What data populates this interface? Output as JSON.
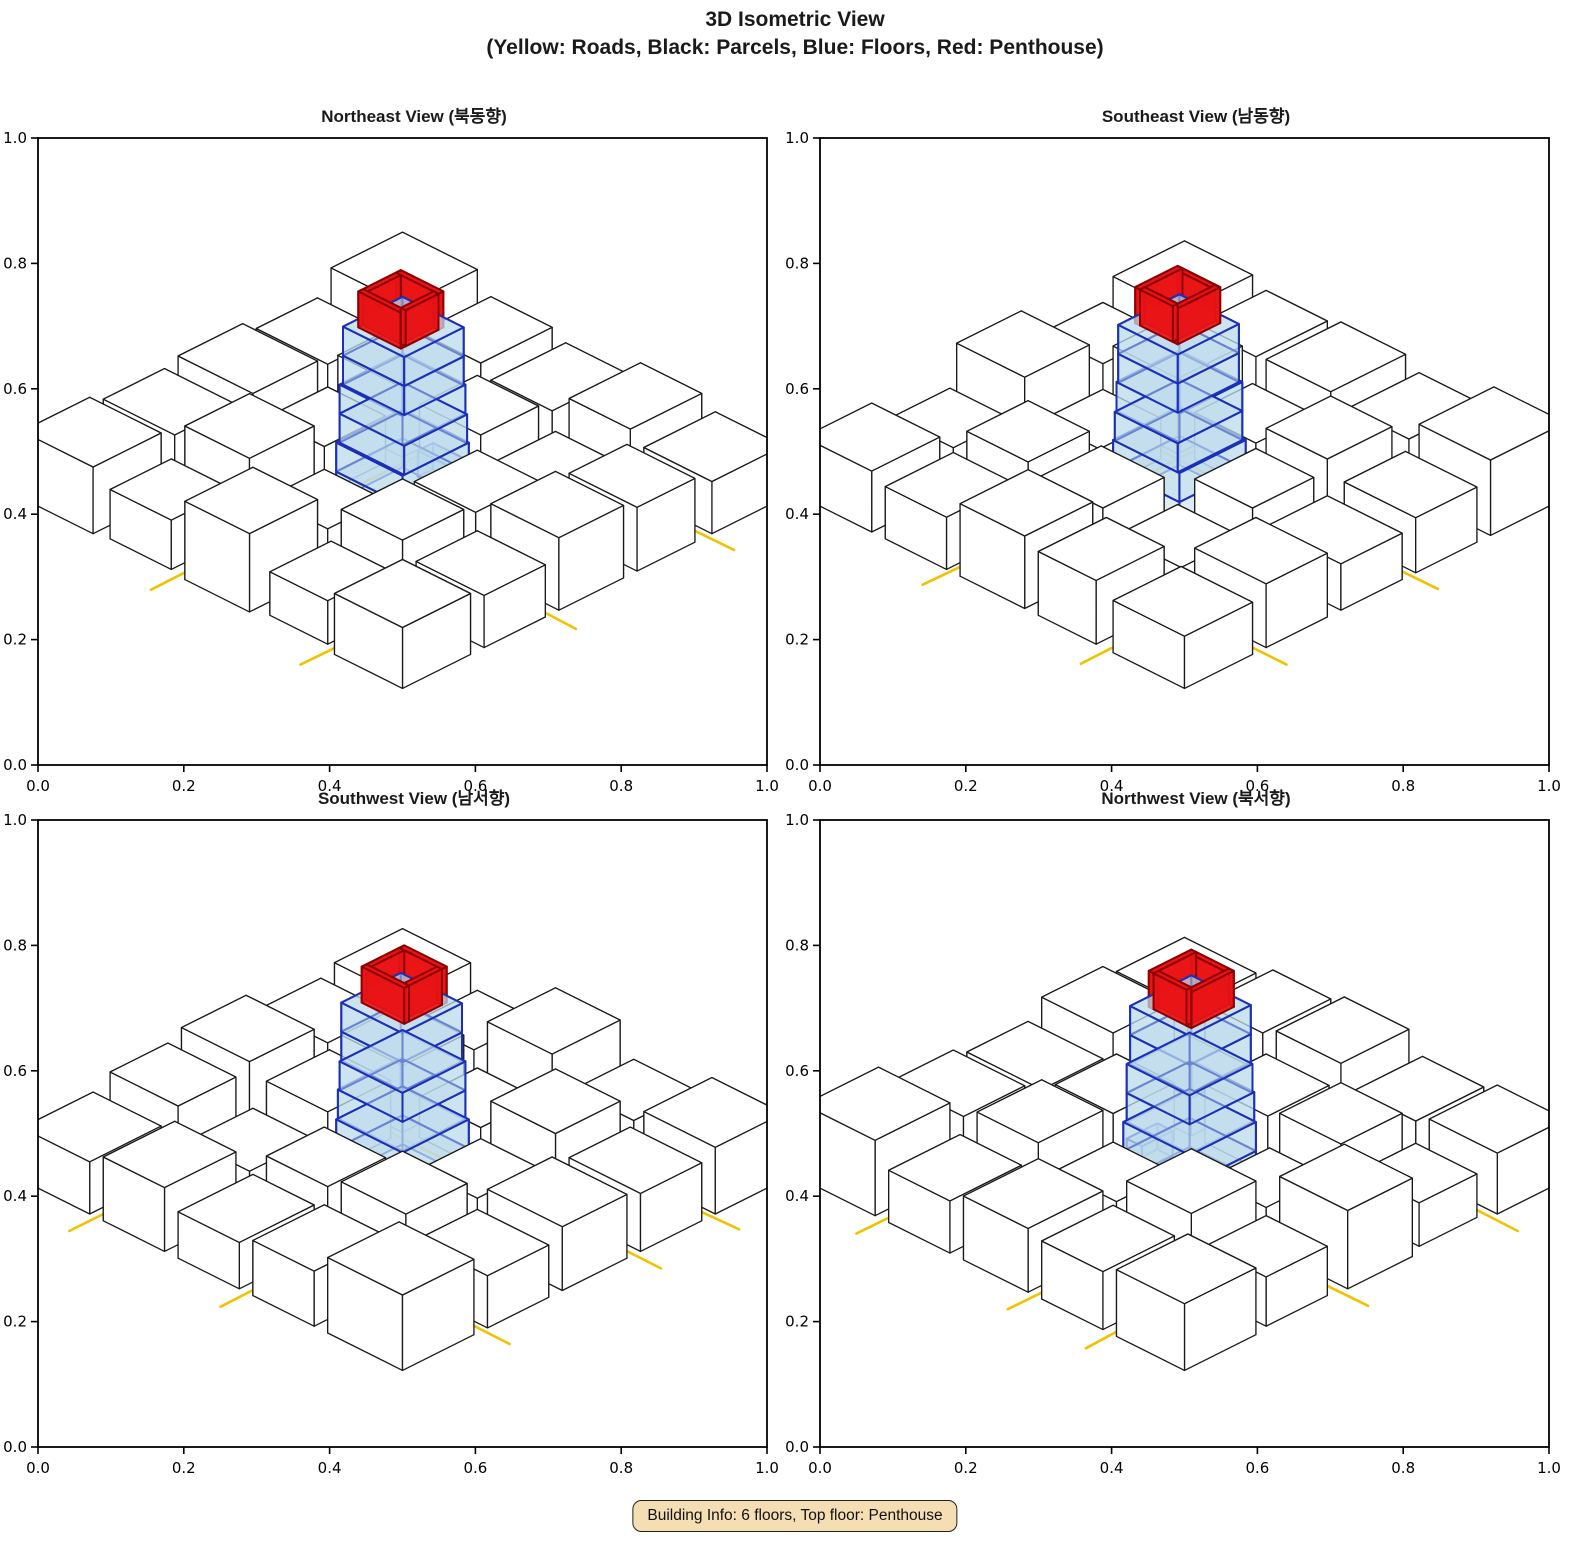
{
  "header": {
    "title_line1": "3D Isometric View",
    "title_line2": "(Yellow: Roads, Black: Parcels, Blue: Floors, Red: Penthouse)"
  },
  "footer": {
    "building_info": "Building Info: 6 floors, Top floor: Penthouse"
  },
  "chart_data": {
    "type": "3d-isometric-multiview",
    "title": "3D Isometric View",
    "subtitle": "(Yellow: Roads, Black: Parcels, Blue: Floors, Red: Penthouse)",
    "views": [
      {
        "title": "Northeast View (북동향)",
        "rotation_deg": 0
      },
      {
        "title": "Southeast View (남동향)",
        "rotation_deg": 90
      },
      {
        "title": "Southwest View (남서향)",
        "rotation_deg": 180
      },
      {
        "title": "Northwest View (북서향)",
        "rotation_deg": 270
      }
    ],
    "axes": {
      "xlim": [
        0.0,
        1.0
      ],
      "ylim": [
        0.0,
        1.0
      ],
      "tick_labels": [
        "0.0",
        "0.2",
        "0.4",
        "0.6",
        "0.8",
        "1.0"
      ]
    },
    "legend": {
      "roads": "Yellow",
      "parcels": "Black",
      "floors": "Blue",
      "penthouse": "Red"
    },
    "building_info": {
      "floors": 6,
      "top_floor": "Penthouse"
    },
    "colors": {
      "road": "#f2c200",
      "parcel_fill": "#ffffff",
      "parcel_edge": "#1a1a1a",
      "floor_fill": "#bcd9ec",
      "floor_edge": "#1b2fb8",
      "penthouse_fill": "#e81416",
      "penthouse_edge": "#8e0000",
      "info_bg": "#f5deb3",
      "axis": "#000000"
    },
    "scene": {
      "parcels": [
        [
          -5.6,
          3.6,
          -3.5,
          5.6,
          1.15
        ],
        [
          -3.1,
          3.7,
          -1.3,
          5.5,
          0.85
        ],
        [
          -0.8,
          3.6,
          1.1,
          5.6,
          1.35
        ],
        [
          1.5,
          3.6,
          3.2,
          5.4,
          0.75
        ],
        [
          3.6,
          3.6,
          5.6,
          5.6,
          1.05
        ],
        [
          -5.6,
          1.4,
          -3.5,
          3.2,
          1.0
        ],
        [
          -3.1,
          1.4,
          -1.2,
          3.3,
          1.3
        ],
        [
          -0.8,
          1.5,
          1.0,
          3.2,
          0.7
        ],
        [
          1.4,
          1.4,
          3.2,
          3.2,
          1.15
        ],
        [
          3.6,
          1.4,
          5.6,
          3.2,
          0.9
        ],
        [
          -5.6,
          -0.9,
          -3.4,
          1.0,
          1.1
        ],
        [
          -3.0,
          -0.8,
          -1.3,
          1.0,
          0.8
        ],
        [
          1.4,
          -0.8,
          3.2,
          1.05,
          1.0
        ],
        [
          3.6,
          -0.9,
          5.6,
          1.0,
          1.25
        ],
        [
          -5.6,
          -3.1,
          -3.5,
          -1.3,
          0.9
        ],
        [
          -3.1,
          -3.0,
          -1.2,
          -1.2,
          1.2
        ],
        [
          -0.8,
          -3.0,
          1.0,
          -1.3,
          1.0
        ],
        [
          1.4,
          -3.1,
          3.2,
          -1.2,
          0.65
        ],
        [
          3.6,
          -3.0,
          5.6,
          -1.3,
          1.1
        ],
        [
          -5.6,
          -5.6,
          -3.4,
          -3.5,
          1.3
        ],
        [
          -3.0,
          -5.6,
          -1.2,
          -3.5,
          0.95
        ],
        [
          -0.8,
          -5.6,
          1.0,
          -3.4,
          0.8
        ],
        [
          1.4,
          -5.6,
          3.2,
          -3.5,
          1.1
        ],
        [
          3.6,
          -5.6,
          5.6,
          -3.5,
          0.9
        ]
      ],
      "roads": [
        [
          [
            -1.05,
            -6.4
          ],
          [
            -1.0,
            -2.0
          ],
          [
            -1.05,
            2.2
          ],
          [
            -1.0,
            6.4
          ]
        ],
        [
          [
            -6.4,
            1.2
          ],
          [
            -1.5,
            1.25
          ],
          [
            2.5,
            1.2
          ],
          [
            6.4,
            1.3
          ]
        ],
        [
          [
            -6.4,
            -3.25
          ],
          [
            -0.5,
            -3.2
          ],
          [
            2.2,
            -3.3
          ],
          [
            6.4,
            -3.35
          ]
        ],
        [
          [
            3.4,
            -6.4
          ],
          [
            3.4,
            -0.5
          ],
          [
            3.45,
            3.0
          ],
          [
            3.4,
            6.4
          ]
        ],
        [
          [
            -6.4,
            3.5
          ],
          [
            -4.4,
            3.42
          ]
        ]
      ],
      "building": {
        "floors": [
          {
            "x0": -0.9,
            "y0": -0.9,
            "x1": 1.05,
            "y1": 1.05,
            "z0": 0.0,
            "z1": 0.5
          },
          {
            "x0": -0.9,
            "y0": -0.9,
            "x1": 1.05,
            "y1": 1.05,
            "z0": 0.5,
            "z1": 1.0
          },
          {
            "x0": -0.85,
            "y0": -0.85,
            "x1": 1.05,
            "y1": 1.0,
            "z0": 1.0,
            "z1": 1.5
          },
          {
            "x0": -0.85,
            "y0": -0.85,
            "x1": 1.0,
            "y1": 1.0,
            "z0": 1.5,
            "z1": 2.0
          },
          {
            "x0": -0.8,
            "y0": -0.8,
            "x1": 1.0,
            "y1": 0.95,
            "z0": 2.0,
            "z1": 2.5
          },
          {
            "x0": -0.8,
            "y0": -0.8,
            "x1": 1.0,
            "y1": 0.95,
            "z0": 2.5,
            "z1": 3.0
          },
          {
            "x0": -0.4,
            "y0": -1.3,
            "x1": 0.5,
            "y1": -0.85,
            "z0": 0.0,
            "z1": 0.45
          }
        ],
        "penthouse": {
          "x0": -0.55,
          "y0": -0.5,
          "x1": 0.7,
          "y1": 0.75,
          "z0": 3.0,
          "z1": 3.62,
          "wall": 0.14
        }
      }
    }
  }
}
